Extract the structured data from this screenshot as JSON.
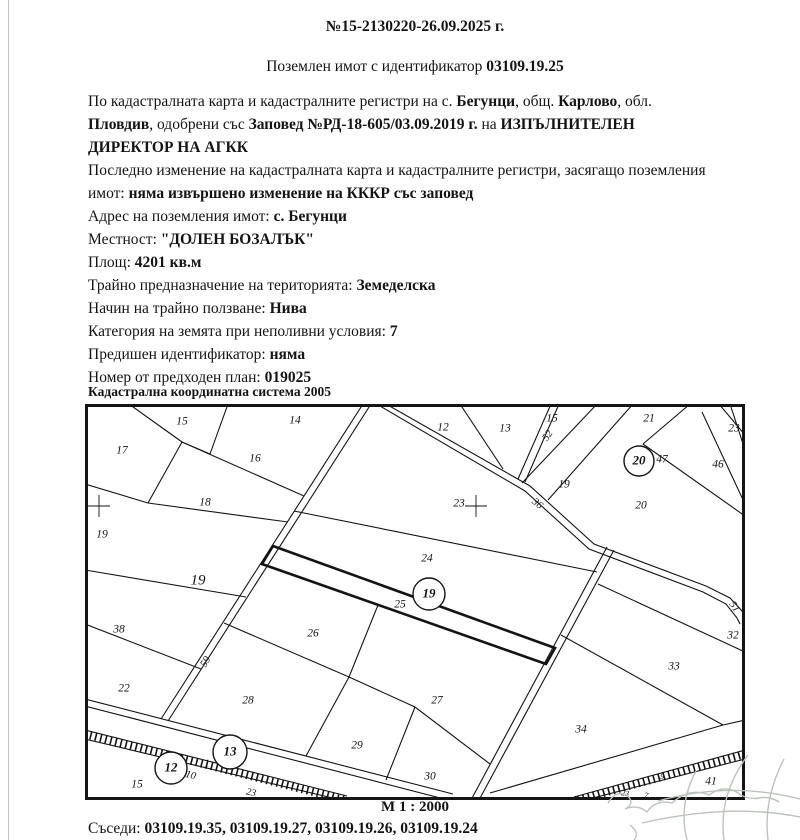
{
  "doc": {
    "number": "№15-2130220-26.09.2025 г.",
    "subtitle": [
      {
        "t": "Поземлен имот с идентификатор "
      },
      {
        "t": "03109.19.25",
        "b": true
      }
    ],
    "lines": [
      [
        {
          "t": "По кадастралната карта и кадастралните регистри на с. "
        },
        {
          "t": "Бегунци",
          "b": true
        },
        {
          "t": ", общ. "
        },
        {
          "t": "Карлово",
          "b": true
        },
        {
          "t": ", обл."
        }
      ],
      [
        {
          "t": "Пловдив",
          "b": true
        },
        {
          "t": ", одобрени със "
        },
        {
          "t": "Заповед №РД-18-605/03.09.2019 г.",
          "b": true
        },
        {
          "t": " на "
        },
        {
          "t": "ИЗПЪЛНИТЕЛЕН",
          "b": true
        }
      ],
      [
        {
          "t": "ДИРЕКТОР НА АГКК",
          "b": true
        }
      ],
      [
        {
          "t": "Последно изменение на кадастралната карта и кадастралните регистри, засягащо поземления"
        }
      ],
      [
        {
          "t": "имот: "
        },
        {
          "t": "няма извършено изменение на КККР със заповед",
          "b": true
        }
      ],
      [
        {
          "t": "Адрес на поземления имот: "
        },
        {
          "t": "с. Бегунци",
          "b": true
        }
      ],
      [
        {
          "t": "Местност: "
        },
        {
          "t": "\"ДОЛЕН БОЗАЛЪК\"",
          "b": true
        }
      ],
      [
        {
          "t": "Площ: "
        },
        {
          "t": "4201 кв.м",
          "b": true
        }
      ],
      [
        {
          "t": "Трайно предназначение на територията: "
        },
        {
          "t": "Земеделска",
          "b": true
        }
      ],
      [
        {
          "t": "Начин на трайно ползване: "
        },
        {
          "t": "Нива",
          "b": true
        }
      ],
      [
        {
          "t": "Категория на земята при неполивни условия: "
        },
        {
          "t": "7",
          "b": true
        }
      ],
      [
        {
          "t": "Предишен идентификатор: "
        },
        {
          "t": "няма",
          "b": true
        }
      ],
      [
        {
          "t": "Номер от предходен план: "
        },
        {
          "t": "019025",
          "b": true
        }
      ]
    ],
    "coord_system": "Кадастрална координатна система 2005",
    "scale": "М 1 : 2000",
    "neighbors": [
      {
        "t": "Съседи: "
      },
      {
        "t": "03109.19.35, 03109.19.27, 03109.19.26, 03109.19.24",
        "b": true
      }
    ]
  },
  "map": {
    "subject_parcel": "25",
    "labels": [
      {
        "t": "15",
        "x": 97,
        "y": 18
      },
      {
        "t": "14",
        "x": 210,
        "y": 17
      },
      {
        "t": "17",
        "x": 37,
        "y": 47
      },
      {
        "t": "16",
        "x": 170,
        "y": 55
      },
      {
        "t": "18",
        "x": 120,
        "y": 99
      },
      {
        "t": "19",
        "x": 17,
        "y": 131
      },
      {
        "t": "19",
        "x": 113,
        "y": 177,
        "s": 15
      },
      {
        "t": "38",
        "x": 34,
        "y": 226
      },
      {
        "t": "22",
        "x": 39,
        "y": 285
      },
      {
        "t": "28",
        "x": 163,
        "y": 297
      },
      {
        "t": "26",
        "x": 228,
        "y": 230
      },
      {
        "t": "24",
        "x": 342,
        "y": 155
      },
      {
        "t": "25",
        "x": 315,
        "y": 201
      },
      {
        "t": "12",
        "x": 358,
        "y": 24
      },
      {
        "t": "13",
        "x": 420,
        "y": 25
      },
      {
        "t": "15",
        "x": 467,
        "y": 15
      },
      {
        "t": "19",
        "x": 479,
        "y": 81
      },
      {
        "t": "23",
        "x": 374,
        "y": 100
      },
      {
        "t": "21",
        "x": 564,
        "y": 15
      },
      {
        "t": "23",
        "x": 649,
        "y": 25
      },
      {
        "t": "47",
        "x": 577,
        "y": 56
      },
      {
        "t": "46",
        "x": 633,
        "y": 61
      },
      {
        "t": "20",
        "x": 556,
        "y": 102
      },
      {
        "t": "32",
        "x": 648,
        "y": 232
      },
      {
        "t": "33",
        "x": 589,
        "y": 263
      },
      {
        "t": "34",
        "x": 496,
        "y": 326
      },
      {
        "t": "27",
        "x": 352,
        "y": 297
      },
      {
        "t": "29",
        "x": 272,
        "y": 342
      },
      {
        "t": "30",
        "x": 345,
        "y": 373
      },
      {
        "t": "41",
        "x": 626,
        "y": 378
      },
      {
        "t": "15",
        "x": 52,
        "y": 381
      },
      {
        "t": "1",
        "x": 122,
        "y": 360,
        "s": 10
      },
      {
        "t": "23",
        "x": 166,
        "y": 389,
        "s": 10,
        "r": 12
      },
      {
        "t": "9",
        "x": 577,
        "y": 373,
        "s": 8,
        "r": 10
      },
      {
        "t": "23",
        "x": 540,
        "y": 390,
        "s": 8,
        "r": 10
      },
      {
        "t": "7",
        "x": 561,
        "y": 392,
        "s": 8,
        "r": 10
      }
    ],
    "road_labels": [
      {
        "t": "59",
        "x": 121,
        "y": 258,
        "r": -60
      },
      {
        "t": "52",
        "x": 463,
        "y": 32,
        "r": -55
      },
      {
        "t": "36",
        "x": 452,
        "y": 100,
        "r": 40
      },
      {
        "t": "51",
        "x": 649,
        "y": 203,
        "r": 55
      },
      {
        "t": "510",
        "x": 103,
        "y": 371,
        "r": 14
      }
    ],
    "circled": [
      {
        "t": "19",
        "x": 344,
        "y": 190,
        "cr": 16
      },
      {
        "t": "20",
        "x": 554,
        "y": 57,
        "cr": 15
      },
      {
        "t": "13",
        "x": 145,
        "y": 348,
        "cr": 17
      },
      {
        "t": "12",
        "x": 86,
        "y": 364,
        "cr": 16
      }
    ],
    "crosses": [
      {
        "x": 14,
        "y": 102
      },
      {
        "x": 391,
        "y": 102
      }
    ],
    "line_color": "#141414"
  }
}
